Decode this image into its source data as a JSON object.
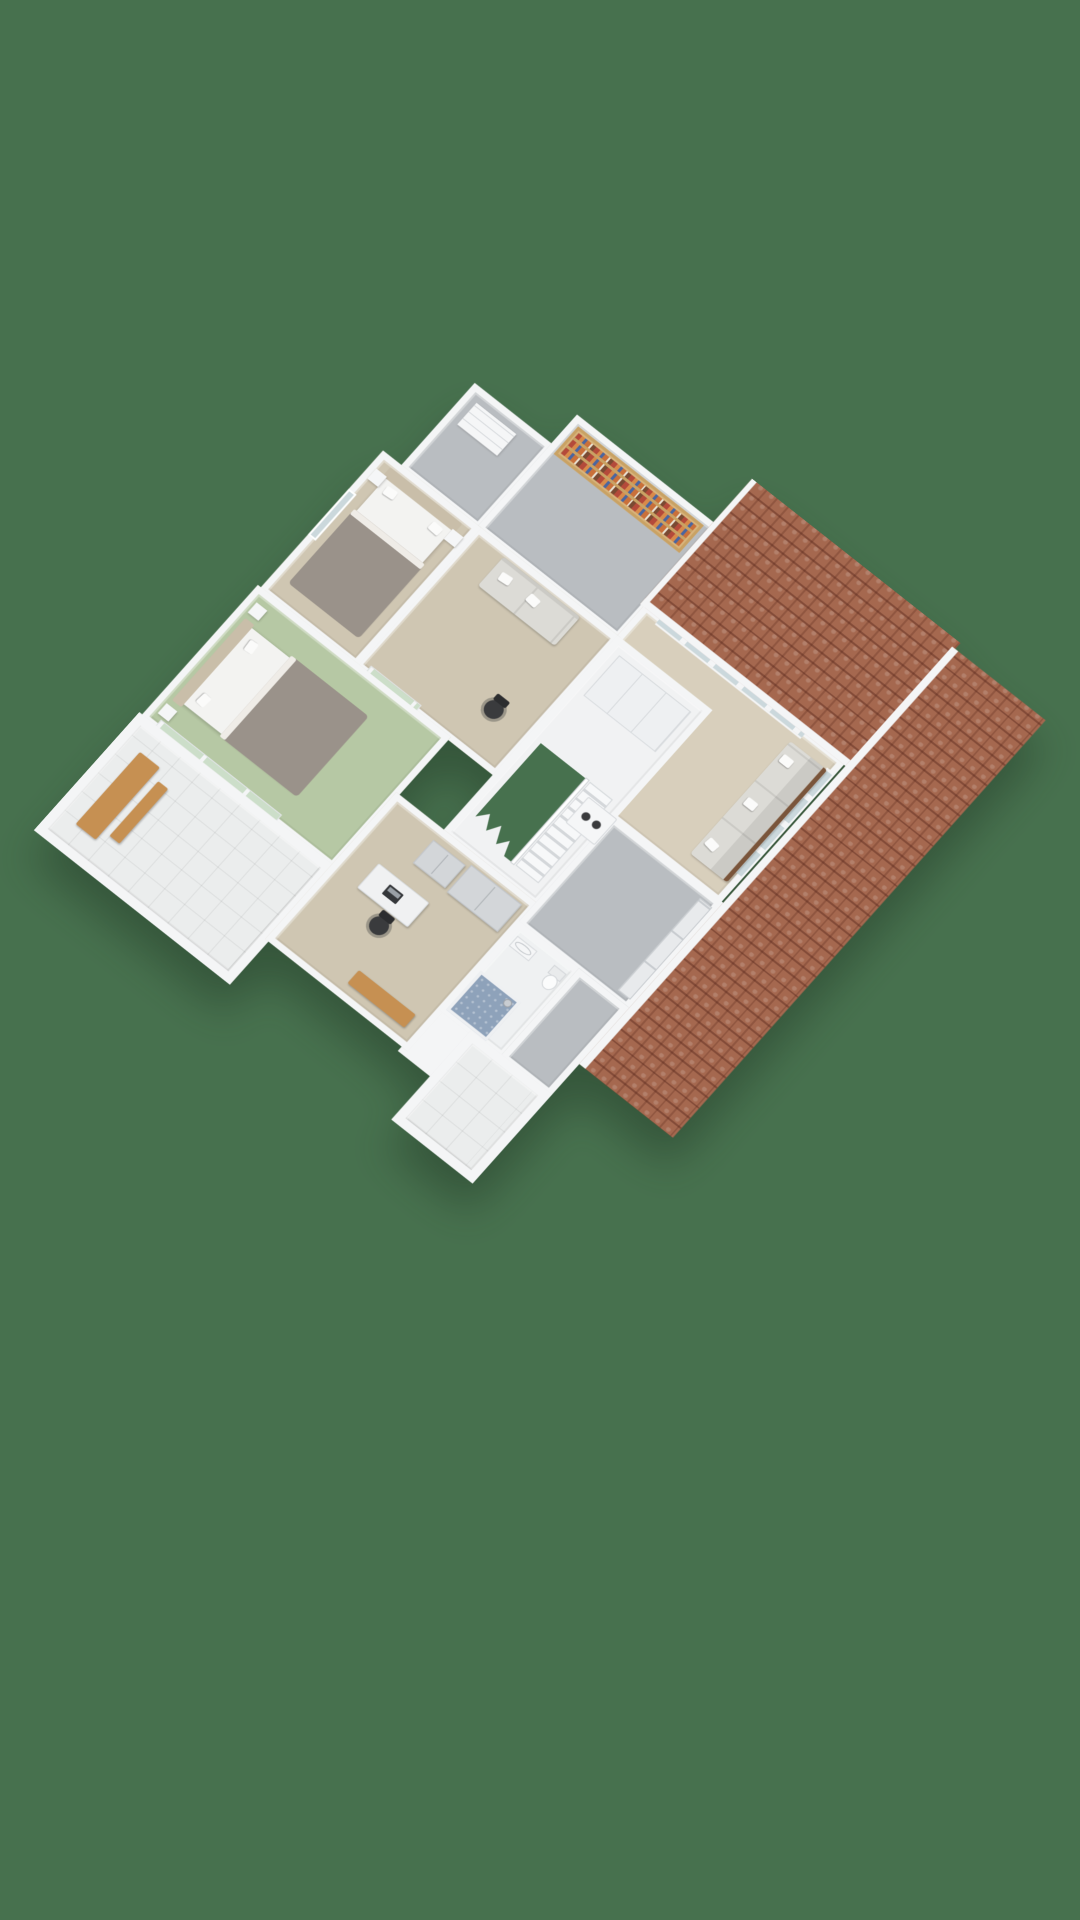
{
  "app": {
    "type": "3d-floorplan-dollhouse-render",
    "text_visible": false,
    "orientation": "portrait"
  },
  "palette": {
    "bg": "#47714E",
    "wall": "#F4F5F6",
    "wall_shade": "#DDE0E3",
    "wall_face": "#C6CACE",
    "floor_gray": "#B9BDC1",
    "floor_beige": "#D8CFBC",
    "floor_tan": "#CFC6B2",
    "floor_green": "#B6C8A4",
    "floor_tile": "#EBEDED",
    "shower_blue": "#8EA2BA",
    "glass_blue": "#CBD8DC",
    "glass_green": "#CCDEC9",
    "roof": "#A5684F",
    "roof_dark": "#7E4A3A",
    "wood_light": "#D8B47C",
    "wood_mid": "#C69052",
    "wood_dark": "#7A553B",
    "fabric": "#DCDBD6",
    "fabric_dark": "#CBCAC5",
    "duvet": "#9A928A",
    "headboard": "#C9BEA9",
    "black": "#3A3B3D",
    "appliance": "#F5F6F7"
  },
  "scene": {
    "projection": "isometric-dollhouse",
    "background_color": "#47714E",
    "roof_sections": [
      {
        "name": "roof-north",
        "material": "terracotta-tile"
      },
      {
        "name": "roof-east",
        "material": "terracotta-tile"
      }
    ],
    "rooms": [
      {
        "name": "small-room",
        "floor": "gray",
        "furniture": [
          "dresser"
        ]
      },
      {
        "name": "library",
        "floor": "gray",
        "furniture": [
          "bookshelf-with-books"
        ]
      },
      {
        "name": "living-room",
        "floor": "beige",
        "furniture": [
          "three-seat-sofa",
          "rattan-armchair"
        ],
        "features": [
          "band-window-north",
          "band-window-east"
        ]
      },
      {
        "name": "hallway-landing",
        "floor": "beige",
        "furniture": [
          "loveseat-sofa",
          "office-chair"
        ],
        "features": [
          "window-south"
        ]
      },
      {
        "name": "bedroom-west",
        "floor": "beige",
        "furniture": [
          "double-bed",
          "nightstand",
          "nightstand"
        ],
        "features": [
          "window-west"
        ]
      },
      {
        "name": "bedroom-green",
        "floor": "green",
        "furniture": [
          "double-bed",
          "nightstand",
          "nightstand"
        ],
        "features": [
          "sliding-glass-door"
        ]
      },
      {
        "name": "balcony-main",
        "floor": "white-tile",
        "furniture": [
          "wood-table",
          "wood-bench"
        ],
        "features": [
          "parapet-wall"
        ]
      },
      {
        "name": "stair-hall",
        "floor": "white",
        "furniture": [
          "built-in-closet"
        ],
        "features": [
          "staircase",
          "floor-opening"
        ]
      },
      {
        "name": "storage-attic-north",
        "floor": "gray",
        "features": [
          "closet-doors"
        ]
      },
      {
        "name": "bathroom",
        "floor": "white",
        "furniture": [
          "shower",
          "toilet",
          "sink"
        ]
      },
      {
        "name": "storage-attic-south",
        "floor": "gray",
        "furniture": []
      },
      {
        "name": "balcony-small",
        "floor": "white-tile",
        "furniture": [],
        "features": [
          "parapet-wall"
        ]
      },
      {
        "name": "laundry-spot",
        "floor": "white",
        "furniture": [
          "washing-machine"
        ]
      }
    ]
  }
}
